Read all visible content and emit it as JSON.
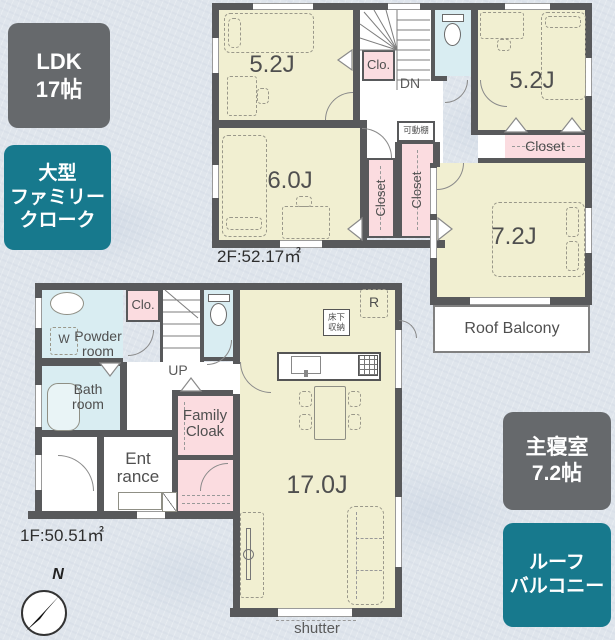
{
  "colors": {
    "background": "#dfe5ec",
    "wall": "#58595b",
    "room_fill": "#f1efd1",
    "closet_fill": "#fbdce0",
    "wet_room_fill": "#d9edf2",
    "badge_gray": "#66696c",
    "badge_teal": "#17798d",
    "text": "#4f4f4f"
  },
  "badges": {
    "ldk": {
      "line1": "LDK",
      "line2": "17帖"
    },
    "family_cloak": {
      "line1": "大型",
      "line2": "ファミリー",
      "line3": "クローク"
    },
    "master": {
      "line1": "主寝室",
      "line2": "7.2帖"
    },
    "roof_balcony": {
      "line1": "ルーフ",
      "line2": "バルコニー"
    }
  },
  "floor2": {
    "area_label": "2F:52.17㎡",
    "bedroom_nw": "5.2J",
    "bedroom_ne": "5.2J",
    "bedroom_w": "6.0J",
    "master_bedroom": "7.2J",
    "closet_hall": "Clo.",
    "closet_ne": "Closet",
    "closet_left": "Closet",
    "closet_right": "Closet",
    "movable_shelf": "可動棚",
    "stairs": "DN",
    "roof_balcony": "Roof Balcony"
  },
  "floor1": {
    "area_label": "1F:50.51㎡",
    "ldk": "17.0J",
    "closet_hall": "Clo.",
    "powder_line1": "Powder",
    "powder_line2": "room",
    "bath_line1": "Bath",
    "bath_line2": "room",
    "family_cloak_line1": "Family",
    "family_cloak_line2": "Cloak",
    "entrance_line1": "Ent",
    "entrance_line2": "rance",
    "stairs": "UP",
    "underfloor_line1": "床下",
    "underfloor_line2": "収納",
    "fridge": "R",
    "washer": "W",
    "shutter": "shutter"
  },
  "compass": {
    "north": "N"
  }
}
